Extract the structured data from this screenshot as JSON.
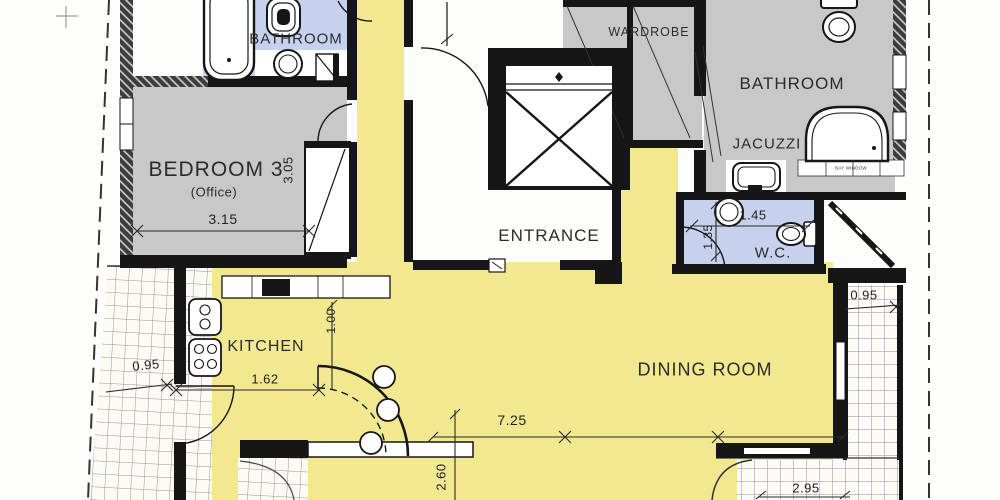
{
  "rooms": {
    "bathroom_top_left": "BATHROOM",
    "bedroom3": "BEDROOM 3",
    "bedroom3_note": "(Office)",
    "entrance": "ENTRANCE",
    "wardrobe": "WARDROBE",
    "bathroom_right": "BATHROOM",
    "jacuzzi": "JACUZZI",
    "wc": "W.C.",
    "kitchen": "KITCHEN",
    "dining_room": "DINING ROOM"
  },
  "dimensions": {
    "bedroom_width": "3.15",
    "bedroom_depth": "3.05",
    "kitchen_counter": "1.62",
    "kitchen_depth": "1.00",
    "living_width": "7.25",
    "living_depth": "2.60",
    "balcony_left_width": "0.95",
    "balcony_right_width": "0.95",
    "balcony_bottom_width": "2.95",
    "wc_width": "1.45",
    "wc_depth": "1.35"
  },
  "small_labels": {
    "bay_window": "BAY WINDOW"
  },
  "colors": {
    "floor_yellow": "#f2e88f",
    "floor_blue": "#c5d1ed",
    "floor_gray": "#c8c8c8",
    "wall_black": "#161616"
  }
}
